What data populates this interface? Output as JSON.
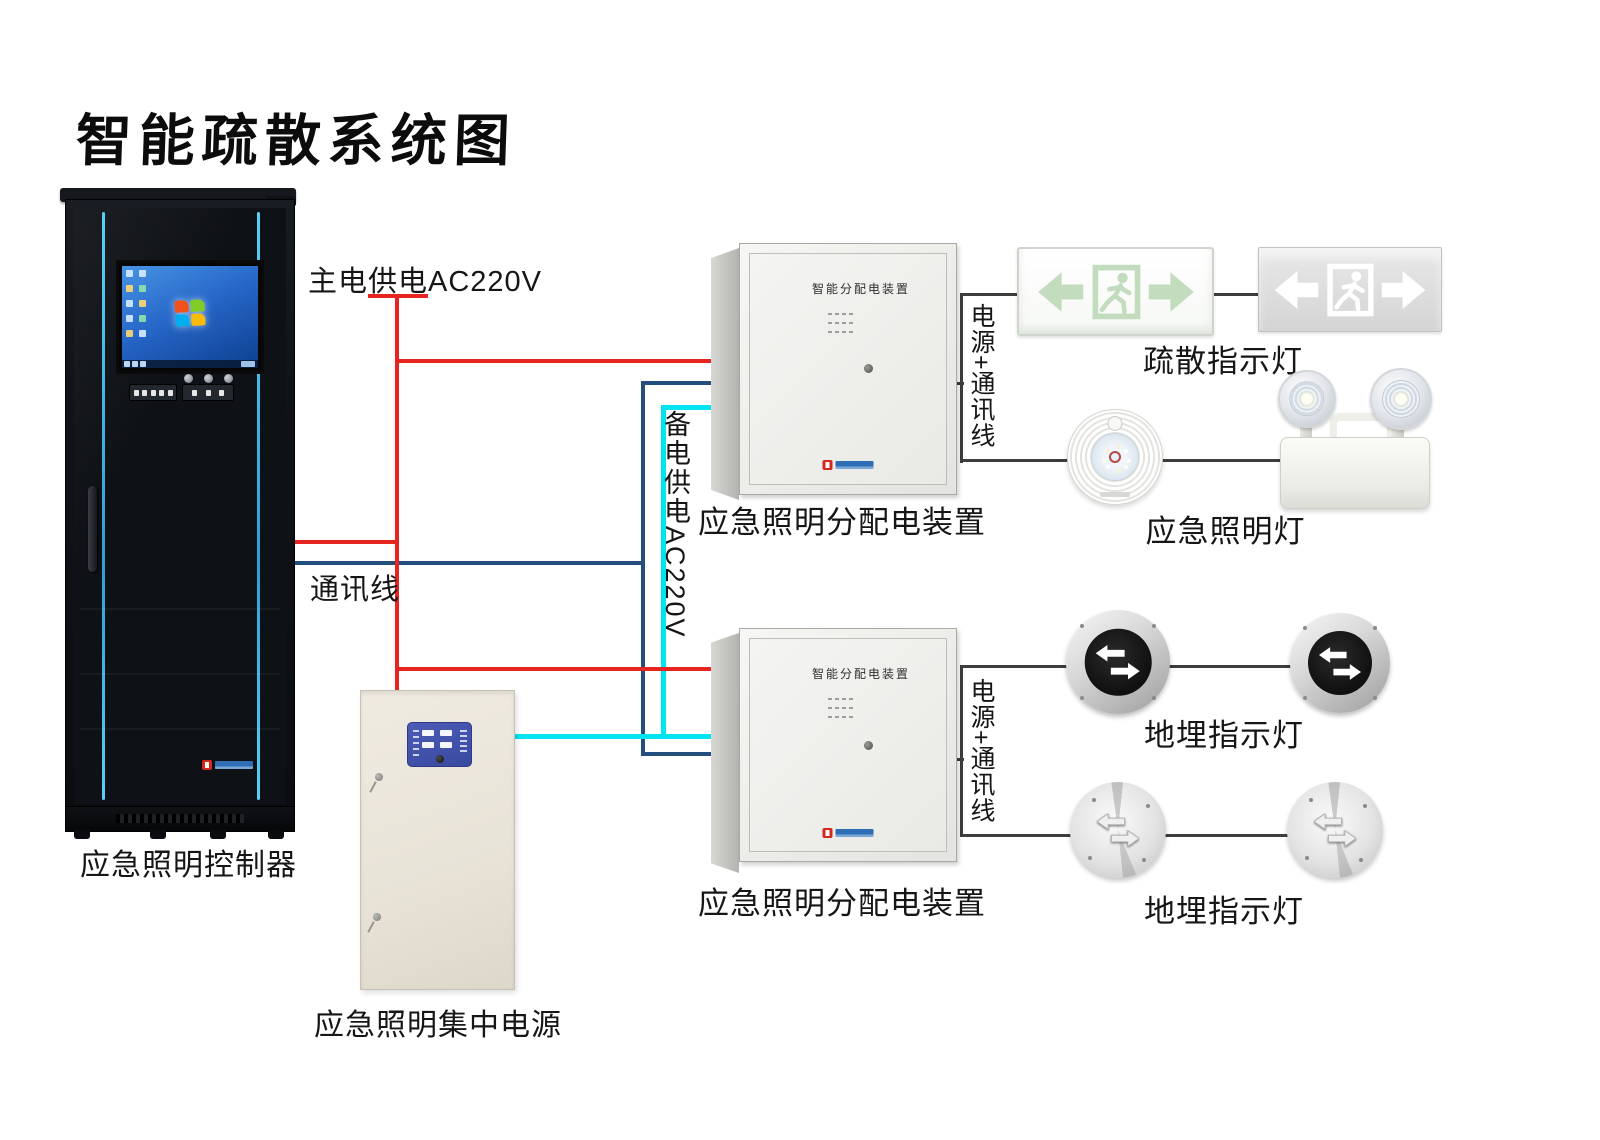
{
  "title": "智能疏散系统图",
  "colors": {
    "main_power": "#e62420",
    "comm_line": "#234e7d",
    "backup_power": "#00e4f2",
    "signal_line": "#3d3d3d",
    "rack_accent": "#45c2f2"
  },
  "labels": {
    "main_power": "主电供电AC220V",
    "comm": "通讯线",
    "backup_power": "备电供电AC220V",
    "bus1": "电源+通讯线",
    "bus2": "电源+通讯线",
    "controller": "应急照明控制器",
    "central_power": "应急照明集中电源",
    "dist_box1": "应急照明分配电装置",
    "dist_box2": "应急照明分配电装置",
    "exit_signs": "疏散指示灯",
    "emergency_lamps": "应急照明灯",
    "ground_lights_row1": "地埋指示灯",
    "ground_lights_row2": "地埋指示灯"
  },
  "panel_title": "智能分配电装置"
}
